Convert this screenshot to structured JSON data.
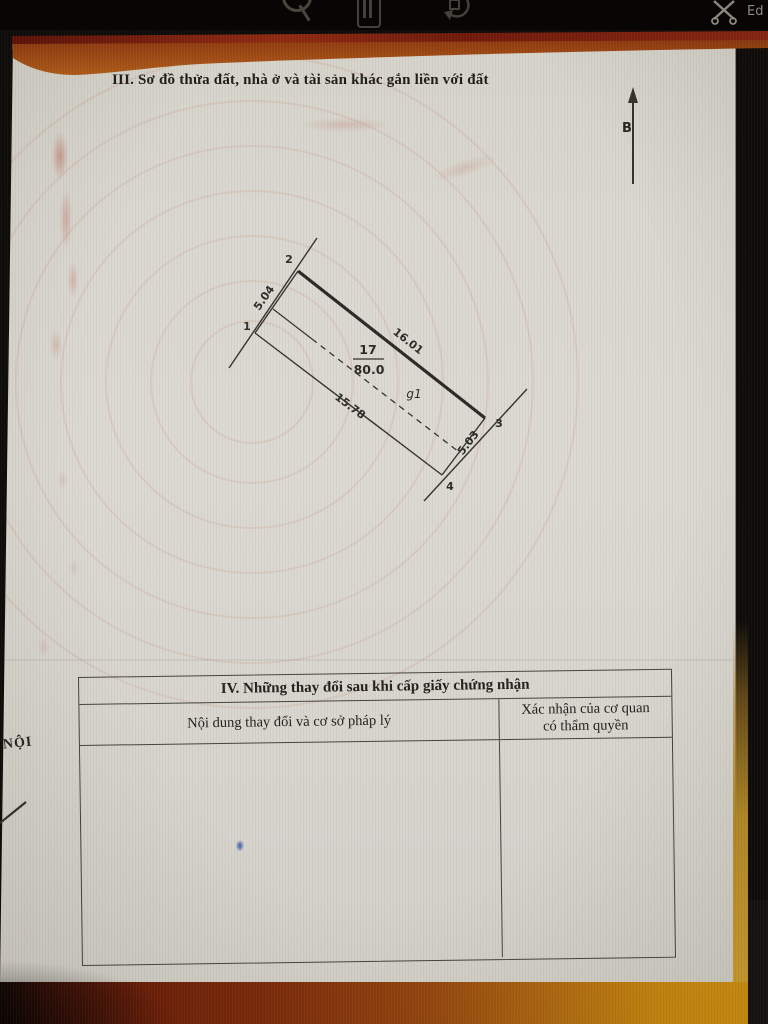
{
  "toolbar": {
    "edit_label": "Ed",
    "icons": [
      "search-icon",
      "pages-icon",
      "rotate-icon",
      "edit-scissors-icon"
    ]
  },
  "document": {
    "section3_title": "III. Sơ đồ thửa đất, nhà ở và tài sản khác gắn liền với đất",
    "side_text": "NỘI",
    "diagram": {
      "north_label": "B",
      "parcel_number": "17",
      "area": "80.0",
      "inner_label": "g1",
      "corner_1": "1",
      "corner_2": "2",
      "corner_3": "3",
      "corner_4": "4",
      "len_1_2": "5.04",
      "len_2_3": "16.01",
      "len_1_4": "15.78",
      "len_3_4": "5.03"
    },
    "section4": {
      "title": "IV. Những thay đổi sau khi cấp giấy chứng nhận",
      "col_content": "Nội dung thay đổi và cơ sở pháp lý",
      "col_confirm_line1": "Xác nhận của cơ quan",
      "col_confirm_line2": "có thẩm quyền"
    }
  },
  "colors": {
    "cover_red": "#7a1d0e",
    "cover_gold": "#c8860e",
    "page": "#d8d6ce",
    "ink_blue": "#4f6cae",
    "line": "#35332d"
  }
}
